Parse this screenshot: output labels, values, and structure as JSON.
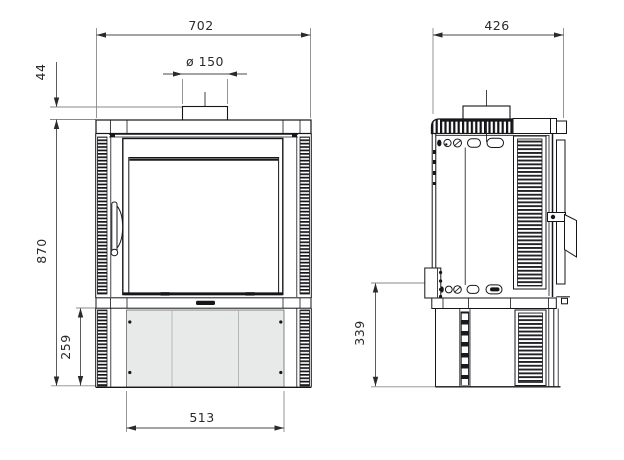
{
  "drawing_name": "stove-dimension-drawing",
  "dims": {
    "front_width": "702",
    "flue_diameter": "ø 150",
    "collar_height": "44",
    "overall_height": "870",
    "pedestal_height": "259",
    "pedestal_width": "513",
    "depth": "426",
    "pedestal_side_height": "339"
  },
  "colors": {
    "line": "#16161a",
    "dim_line": "#4a4a4a",
    "ext_line": "#8a8a8a",
    "panel_fill": "#e8eaea",
    "panel_divider": "#b5b8b8",
    "background": "#ffffff"
  }
}
